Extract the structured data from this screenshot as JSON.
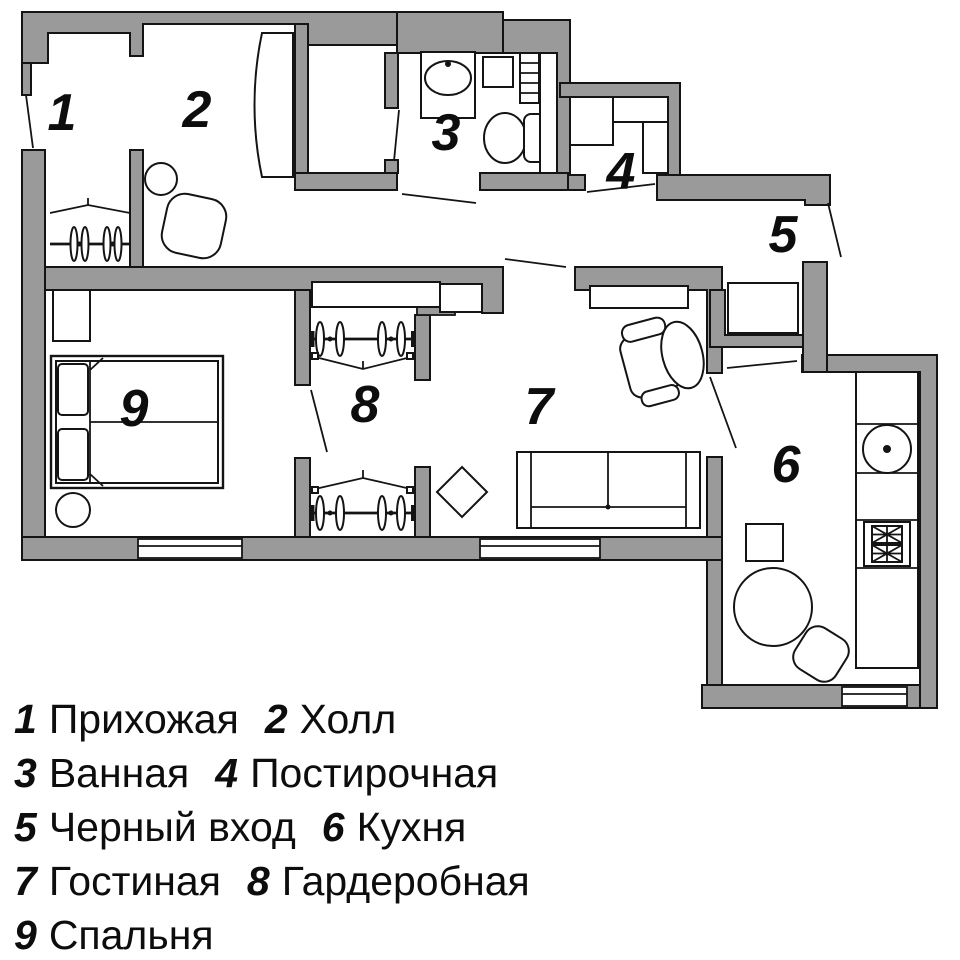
{
  "title": "Apartment floor plan",
  "colors": {
    "wall": "#9a9a9a",
    "line": "#141414",
    "background": "#ffffff"
  },
  "plan": {
    "rooms": [
      {
        "number": "1",
        "name": "Прихожая"
      },
      {
        "number": "2",
        "name": "Холл"
      },
      {
        "number": "3",
        "name": "Ванная"
      },
      {
        "number": "4",
        "name": "Постирочная"
      },
      {
        "number": "5",
        "name": "Черный вход"
      },
      {
        "number": "6",
        "name": "Кухня"
      },
      {
        "number": "7",
        "name": "Гостиная"
      },
      {
        "number": "8",
        "name": "Гардеробная"
      },
      {
        "number": "9",
        "name": "Спальня"
      }
    ]
  },
  "legend": {
    "rows": [
      {
        "a_num": "1",
        "a_label": "Прихожая",
        "b_num": "2",
        "b_label": "Холл"
      },
      {
        "a_num": "3",
        "a_label": "Ванная",
        "b_num": "4",
        "b_label": "Постирочная"
      },
      {
        "a_num": "5",
        "a_label": "Черный вход",
        "b_num": "6",
        "b_label": "Кухня"
      },
      {
        "a_num": "7",
        "a_label": "Гостиная",
        "b_num": "8",
        "b_label": "Гардеробная"
      },
      {
        "a_num": "9",
        "a_label": "Спальня"
      }
    ]
  }
}
